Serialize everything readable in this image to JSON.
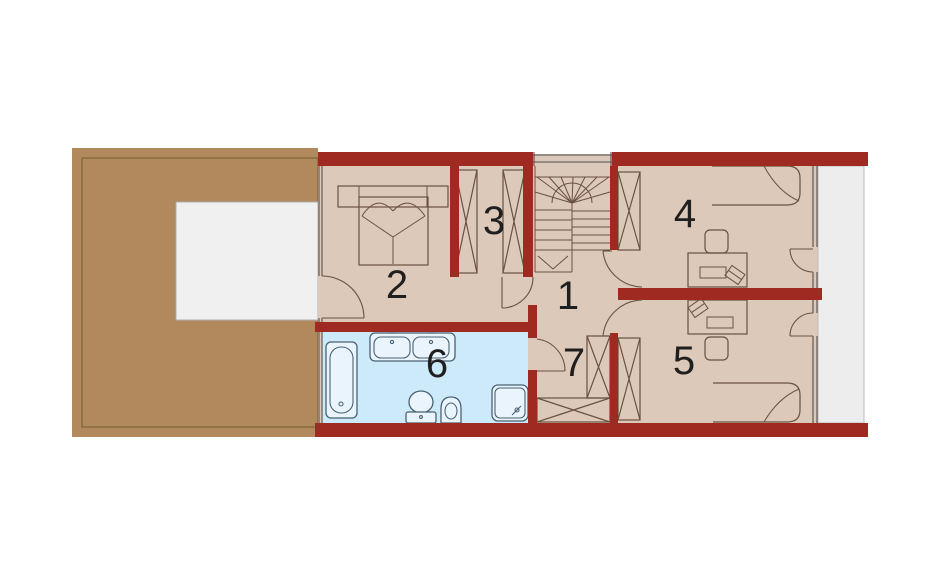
{
  "plan": {
    "type": "architectural-floor-plan",
    "level": "upper-floor",
    "rooms": [
      {
        "number": "1"
      },
      {
        "number": "2"
      },
      {
        "number": "3"
      },
      {
        "number": "4"
      },
      {
        "number": "5"
      },
      {
        "number": "6"
      },
      {
        "number": "7"
      }
    ],
    "fixtures": [
      "bathtub",
      "double-sink",
      "toilet",
      "bidet",
      "shower",
      "double-bed",
      "single-bed",
      "desk",
      "chair",
      "wardrobe",
      "winder-staircase"
    ],
    "areas": [
      "terrace",
      "skylight-opening",
      "bathroom",
      "balcony",
      "hall",
      "stairwell"
    ],
    "colors": {
      "wall": "#9e2a22",
      "terrace": "#b1895c",
      "terrace_border": "#8a6a42",
      "floor": "#dcc9ba",
      "bathroom": "#cdeafa",
      "balcony": "#ededed",
      "balcony_border": "#bdbdbd",
      "skylight": "#f0f0f0",
      "skylight_border": "#b0b0b0",
      "outline": "#6b5140",
      "fixture": "#4a6273",
      "label": "#1f1f1f",
      "background": "#ffffff"
    }
  }
}
